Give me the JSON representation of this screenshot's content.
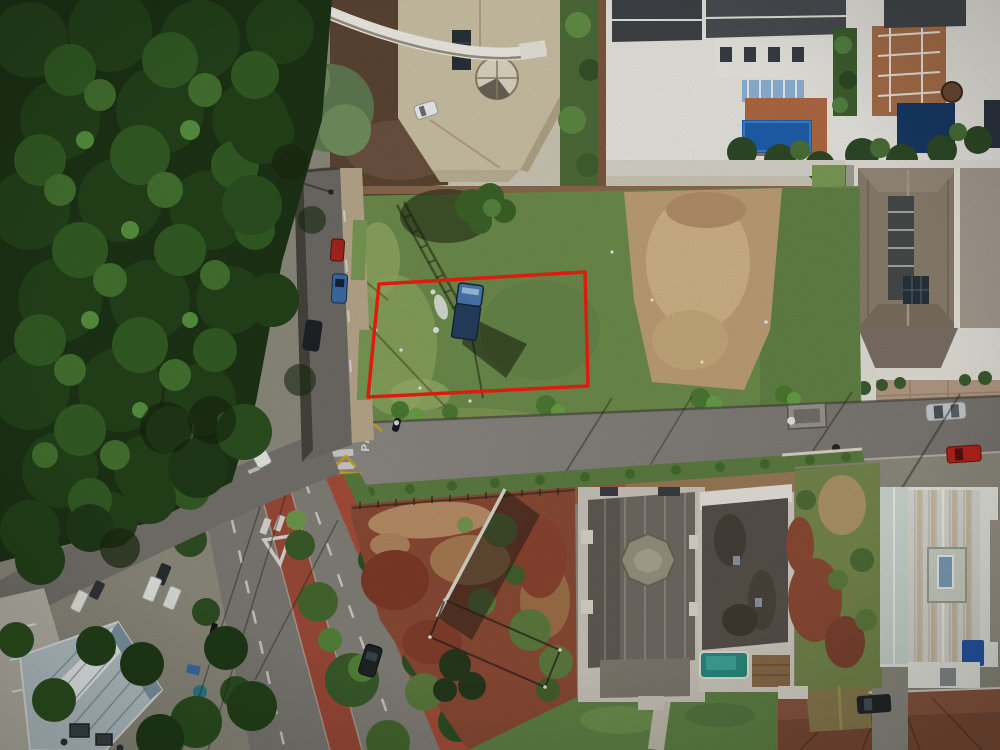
{
  "scene": {
    "type": "aerial-drone-photograph",
    "description": "Top-down drone photo of a residential neighborhood: a vacant grass lot outlined with a red property-boundary rectangle, a blue pickup parked inside it, surrounded by streets, luxury houses with pools, a dense forest at upper left, a divided avenue with red bike lanes, red-soil vacant lots and tiled roofs.",
    "road_markings": {
      "stop_text": "PARE"
    },
    "annotation": {
      "name": "property-boundary-highlight",
      "shape": "rectangle",
      "color": "#ee1f10"
    },
    "palette": {
      "forest": "#1c3315",
      "lot_grass": "#6d8c4c",
      "dry_dirt": "#bfa076",
      "red_soil": "#8a4a35",
      "asphalt": "#84817b",
      "bike_path": "#a24c38",
      "blue_metal_roof": "#b9c6cc",
      "pool_blue": "#1f5fae",
      "truck_blue": "#2a4f7e",
      "tan_roof": "#cdc2a6"
    }
  }
}
